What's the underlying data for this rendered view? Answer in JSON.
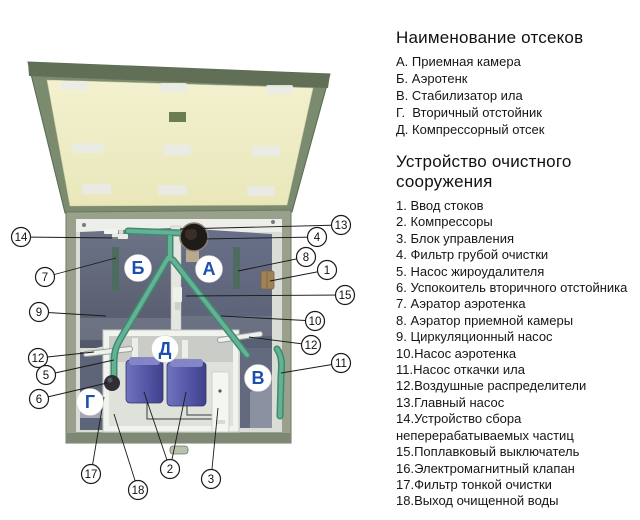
{
  "legend_compartments": {
    "title": "Наименование отсеков",
    "items": [
      {
        "prefix": "А. ",
        "label": "Приемная камера"
      },
      {
        "prefix": "Б. ",
        "label": "Аэротенк"
      },
      {
        "prefix": "В. ",
        "label": "Стабилизатор ила"
      },
      {
        "prefix": "Г.  ",
        "label": "Вторичный отстойник"
      },
      {
        "prefix": "Д. ",
        "label": "Компрессорный отсек"
      }
    ]
  },
  "legend_parts": {
    "title": "Устройство очистного сооружения",
    "items": [
      {
        "prefix": "1. ",
        "label": "Ввод стоков"
      },
      {
        "prefix": "2. ",
        "label": "Компрессоры"
      },
      {
        "prefix": "3. ",
        "label": "Блок управления"
      },
      {
        "prefix": "4. ",
        "label": "Фильтр грубой очистки"
      },
      {
        "prefix": "5. ",
        "label": "Насос жироудалителя"
      },
      {
        "prefix": "6. ",
        "label": "Успокоитель вторичного отстойника"
      },
      {
        "prefix": "7. ",
        "label": "Аэратор аэротенка"
      },
      {
        "prefix": "8. ",
        "label": "Аэратор приемной камеры"
      },
      {
        "prefix": "9. ",
        "label": "Циркуляционный насос"
      },
      {
        "prefix": "10.",
        "label": "Насос аэротенка"
      },
      {
        "prefix": "11.",
        "label": "Насос откачки ила"
      },
      {
        "prefix": "12.",
        "label": "Воздушные распределители"
      },
      {
        "prefix": "13.",
        "label": "Главный насос"
      },
      {
        "prefix": "14.",
        "label": "Устройство сбора неперерабатываемых частиц"
      },
      {
        "prefix": "15.",
        "label": "Поплавковый выключатель"
      },
      {
        "prefix": "16.",
        "label": "Электромагнитный клапан"
      },
      {
        "prefix": "17.",
        "label": "Фильтр тонкой очистки"
      },
      {
        "prefix": "18.",
        "label": "Выход очищенной воды"
      }
    ]
  },
  "diagram": {
    "compartment_letters": [
      {
        "letter": "Б",
        "x": 138,
        "y": 268
      },
      {
        "letter": "А",
        "x": 209,
        "y": 269
      },
      {
        "letter": "Д",
        "x": 165,
        "y": 349
      },
      {
        "letter": "Г",
        "x": 90,
        "y": 402
      },
      {
        "letter": "В",
        "x": 258,
        "y": 378
      }
    ],
    "callouts": [
      {
        "num": "14",
        "x": 21,
        "y": 237,
        "tx": 118,
        "ty": 238
      },
      {
        "num": "7",
        "x": 45,
        "y": 277,
        "tx": 116,
        "ty": 258
      },
      {
        "num": "9",
        "x": 39,
        "y": 312,
        "tx": 106,
        "ty": 316
      },
      {
        "num": "12",
        "x": 38,
        "y": 358,
        "tx": 94,
        "ty": 352
      },
      {
        "num": "5",
        "x": 46,
        "y": 375,
        "tx": 114,
        "ty": 360
      },
      {
        "num": "6",
        "x": 39,
        "y": 399,
        "tx": 107,
        "ty": 383
      },
      {
        "num": "17",
        "x": 91,
        "y": 474,
        "tx": 104,
        "ty": 397
      },
      {
        "num": "18",
        "x": 138,
        "y": 490,
        "tx": 114,
        "ty": 414
      },
      {
        "num": "2",
        "x": 170,
        "y": 469,
        "tx": 144,
        "ty": 392,
        "tx2": 186,
        "ty2": 392
      },
      {
        "num": "3",
        "x": 211,
        "y": 479,
        "tx": 218,
        "ty": 408
      },
      {
        "num": "13",
        "x": 341,
        "y": 225,
        "tx": 180,
        "ty": 229
      },
      {
        "num": "4",
        "x": 317,
        "y": 237,
        "tx": 202,
        "ty": 239
      },
      {
        "num": "8",
        "x": 306,
        "y": 257,
        "tx": 238,
        "ty": 271
      },
      {
        "num": "1",
        "x": 327,
        "y": 270,
        "tx": 270,
        "ty": 281
      },
      {
        "num": "15",
        "x": 345,
        "y": 295,
        "tx": 186,
        "ty": 296
      },
      {
        "num": "10",
        "x": 315,
        "y": 321,
        "tx": 221,
        "ty": 316
      },
      {
        "num": "12",
        "x": 311,
        "y": 345,
        "tx": 249,
        "ty": 337
      },
      {
        "num": "11",
        "x": 341,
        "y": 363,
        "tx": 281,
        "ty": 373
      }
    ],
    "colors": {
      "lid_frame": "#7b8b6f",
      "lid_frame_dark": "#606f56",
      "lid_panel": "#efedc5",
      "tank_wall": "#99a18d",
      "interior": "#dadcd6",
      "chamber_dark": "#646a7e",
      "pipe_green": "#58a78c",
      "compressor_blue": "#5557a9",
      "inlet_brown": "#a08257",
      "letter_blue": "#1d4fae",
      "callout_outline": "#1a1a1a"
    }
  }
}
